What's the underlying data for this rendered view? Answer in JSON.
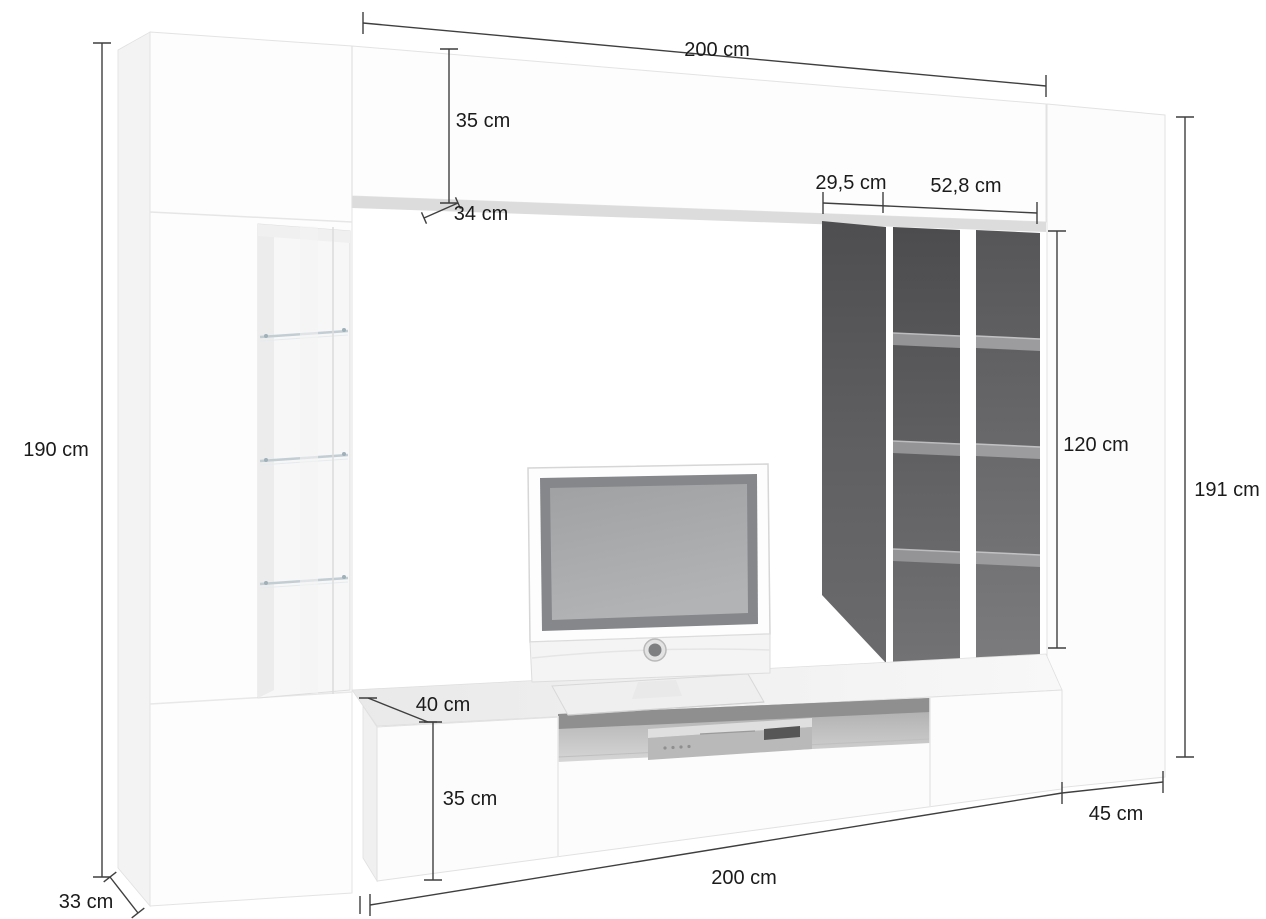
{
  "labels": {
    "top_width": "200 cm",
    "top_cabinet_height": "35 cm",
    "top_cabinet_depth": "34 cm",
    "shelf_niche_left_width": "29,5 cm",
    "shelf_niche_right_width": "52,8 cm",
    "left_column_height": "190 cm",
    "shelf_unit_height": "120 cm",
    "right_column_height": "191 cm",
    "lowboard_depth": "40 cm",
    "lowboard_height": "35 cm",
    "right_column_depth": "45 cm",
    "lowboard_width": "200 cm",
    "left_column_depth": "33 cm"
  },
  "colors": {
    "background": "#ffffff",
    "dimension_line": "#3f3f3f",
    "label_text": "#1b1b1b",
    "furniture_white": "#fcfcfc",
    "shelf_unit_dark": "#58585a",
    "tv_screen_gray": "#a7a9ab"
  }
}
